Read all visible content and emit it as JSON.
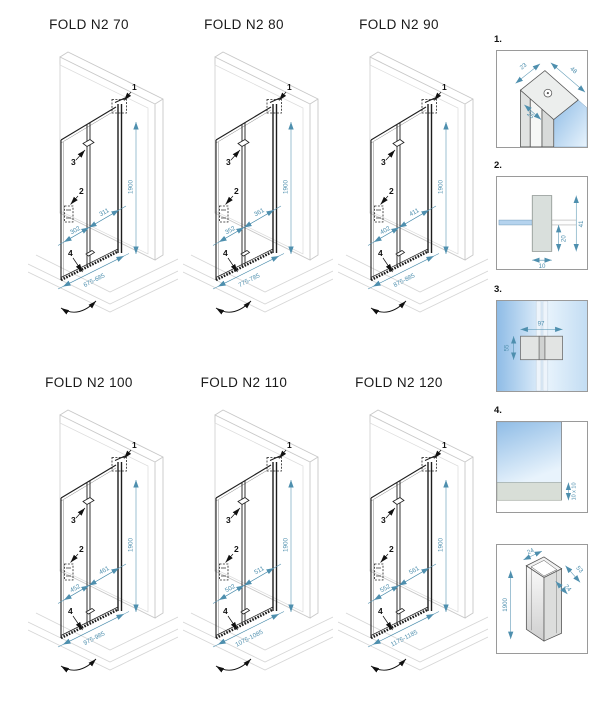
{
  "diagrams": [
    {
      "title": "FOLD N2 70",
      "dim_upper": "311",
      "dim_lower": "302",
      "dim_height": "1900",
      "dim_range": "675-685"
    },
    {
      "title": "FOLD N2 80",
      "dim_upper": "361",
      "dim_lower": "352",
      "dim_height": "1900",
      "dim_range": "775-785"
    },
    {
      "title": "FOLD N2 90",
      "dim_upper": "411",
      "dim_lower": "402",
      "dim_height": "1900",
      "dim_range": "875-885"
    },
    {
      "title": "FOLD N2 100",
      "dim_upper": "461",
      "dim_lower": "452",
      "dim_height": "1900",
      "dim_range": "975-985"
    },
    {
      "title": "FOLD N2 110",
      "dim_upper": "511",
      "dim_lower": "502",
      "dim_height": "1900",
      "dim_range": "1075-1085"
    },
    {
      "title": "FOLD N2 120",
      "dim_upper": "561",
      "dim_lower": "552",
      "dim_height": "1900",
      "dim_range": "1175-1185"
    }
  ],
  "callouts": [
    "1",
    "2",
    "3",
    "4"
  ],
  "details": {
    "d1": {
      "label": "1.",
      "dim_a": "23",
      "dim_b": "48",
      "dim_c": "25"
    },
    "d2": {
      "label": "2.",
      "dim_a": "41",
      "dim_b": "20",
      "dim_c": "10"
    },
    "d3": {
      "label": "3.",
      "dim_a": "97",
      "dim_b": "55"
    },
    "d4": {
      "label": "4.",
      "dim_a": "10 x 10"
    },
    "profile": {
      "dim_top": "24",
      "dim_side": "53",
      "dim_inner": "24",
      "dim_height": "1900"
    }
  },
  "colors": {
    "dimension": "#4e8fae",
    "line": "#1c1c1c",
    "wall": "#c8c8c8",
    "floor": "#d6d6d6",
    "glass_dark": "#8fbce6",
    "glass_light": "#e8f3fc"
  }
}
